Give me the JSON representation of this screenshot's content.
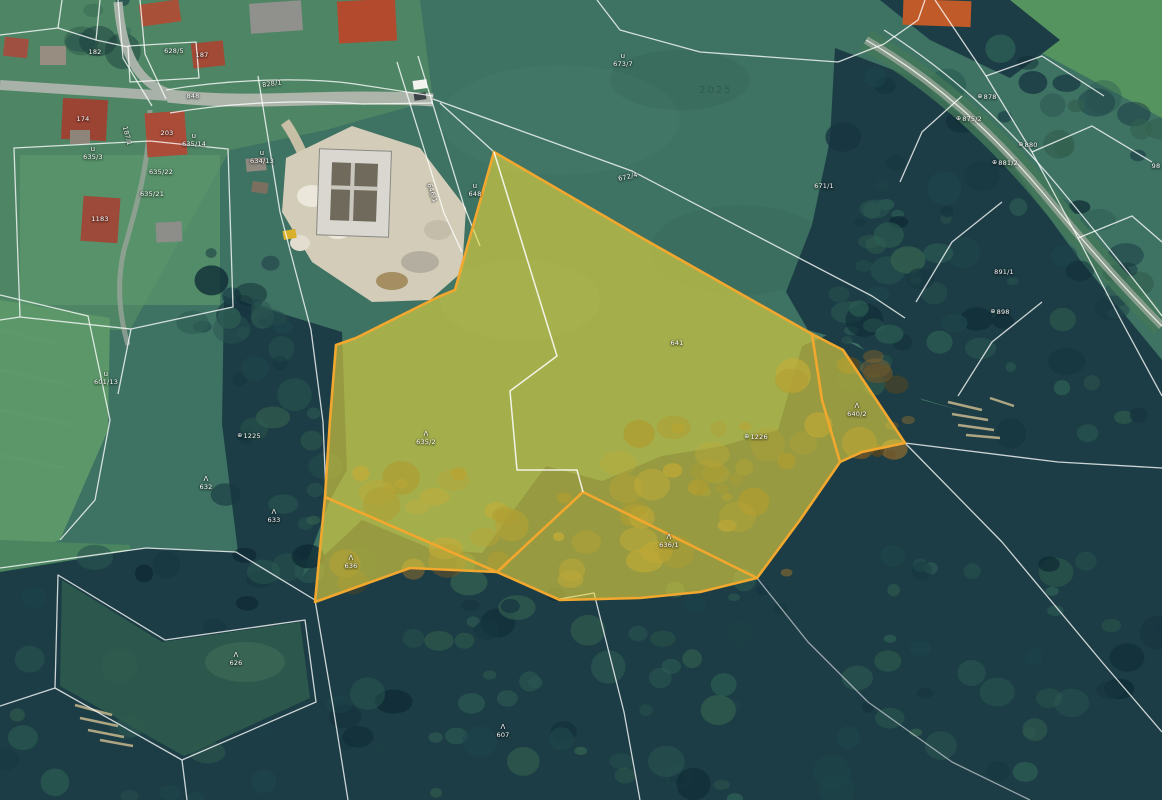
{
  "map": {
    "colors": {
      "highlight_fill": "#ead93e",
      "highlight_border": "#f2a72e",
      "cadastral_line": "#ffffff",
      "field_green": "#3e7263",
      "forest_dark": "#1c3d45"
    },
    "highlighted_parcel_labels": [
      "635/2",
      "641",
      "640/2",
      "636/1",
      "636"
    ],
    "labels": [
      {
        "text": "182",
        "x": 95,
        "y": 52
      },
      {
        "text": "628/5",
        "x": 174,
        "y": 51
      },
      {
        "text": "187",
        "x": 202,
        "y": 55
      },
      {
        "text": "828/1",
        "x": 272,
        "y": 84,
        "rot": -8
      },
      {
        "text": "848",
        "x": 193,
        "y": 96
      },
      {
        "text": "174",
        "x": 83,
        "y": 119
      },
      {
        "text": "187/1",
        "x": 127,
        "y": 136,
        "rot": 75
      },
      {
        "text": "203",
        "x": 167,
        "y": 133
      },
      {
        "text": "635/14",
        "x": 194,
        "y": 140,
        "sym": "u"
      },
      {
        "text": "635/3",
        "x": 93,
        "y": 153,
        "sym": "u"
      },
      {
        "text": "634/13",
        "x": 262,
        "y": 157,
        "sym": "u"
      },
      {
        "text": "635/22",
        "x": 161,
        "y": 172
      },
      {
        "text": "635/21",
        "x": 152,
        "y": 194
      },
      {
        "text": "1183",
        "x": 100,
        "y": 219
      },
      {
        "text": "646/1",
        "x": 432,
        "y": 193,
        "rot": 72
      },
      {
        "text": "648",
        "x": 475,
        "y": 190,
        "sym": "u"
      },
      {
        "text": "672/4",
        "x": 628,
        "y": 177,
        "rot": -13
      },
      {
        "text": "673/7",
        "x": 623,
        "y": 60,
        "sym": "u"
      },
      {
        "text": "671/1",
        "x": 824,
        "y": 186
      },
      {
        "text": "601/13",
        "x": 106,
        "y": 378,
        "sym": "u"
      },
      {
        "text": "1225",
        "x": 249,
        "y": 436,
        "sym": "⊕"
      },
      {
        "text": "632",
        "x": 206,
        "y": 483,
        "sym": "Λ"
      },
      {
        "text": "633",
        "x": 274,
        "y": 516,
        "sym": "Λ"
      },
      {
        "text": "626",
        "x": 236,
        "y": 659,
        "sym": "Λ"
      },
      {
        "text": "607",
        "x": 503,
        "y": 731,
        "sym": "Λ"
      },
      {
        "text": "635/2",
        "x": 426,
        "y": 438,
        "sym": "Λ"
      },
      {
        "text": "641",
        "x": 677,
        "y": 343
      },
      {
        "text": "1226",
        "x": 756,
        "y": 437,
        "sym": "⊕"
      },
      {
        "text": "640/2",
        "x": 857,
        "y": 410,
        "sym": "Λ"
      },
      {
        "text": "636",
        "x": 351,
        "y": 562,
        "sym": "Λ"
      },
      {
        "text": "636/1",
        "x": 669,
        "y": 541,
        "sym": "Λ"
      },
      {
        "text": "878",
        "x": 987,
        "y": 97,
        "sym": "⊕"
      },
      {
        "text": "875/2",
        "x": 969,
        "y": 119,
        "sym": "⊕"
      },
      {
        "text": "880",
        "x": 1028,
        "y": 145,
        "sym": "⊕"
      },
      {
        "text": "881/2",
        "x": 1005,
        "y": 163,
        "sym": "⊕"
      },
      {
        "text": "891/1",
        "x": 1004,
        "y": 272
      },
      {
        "text": "898",
        "x": 1000,
        "y": 312,
        "sym": "⊕"
      },
      {
        "text": "98",
        "x": 1156,
        "y": 166
      },
      {
        "text": "2025",
        "x": 716,
        "y": 91,
        "cls": "wm"
      }
    ]
  }
}
